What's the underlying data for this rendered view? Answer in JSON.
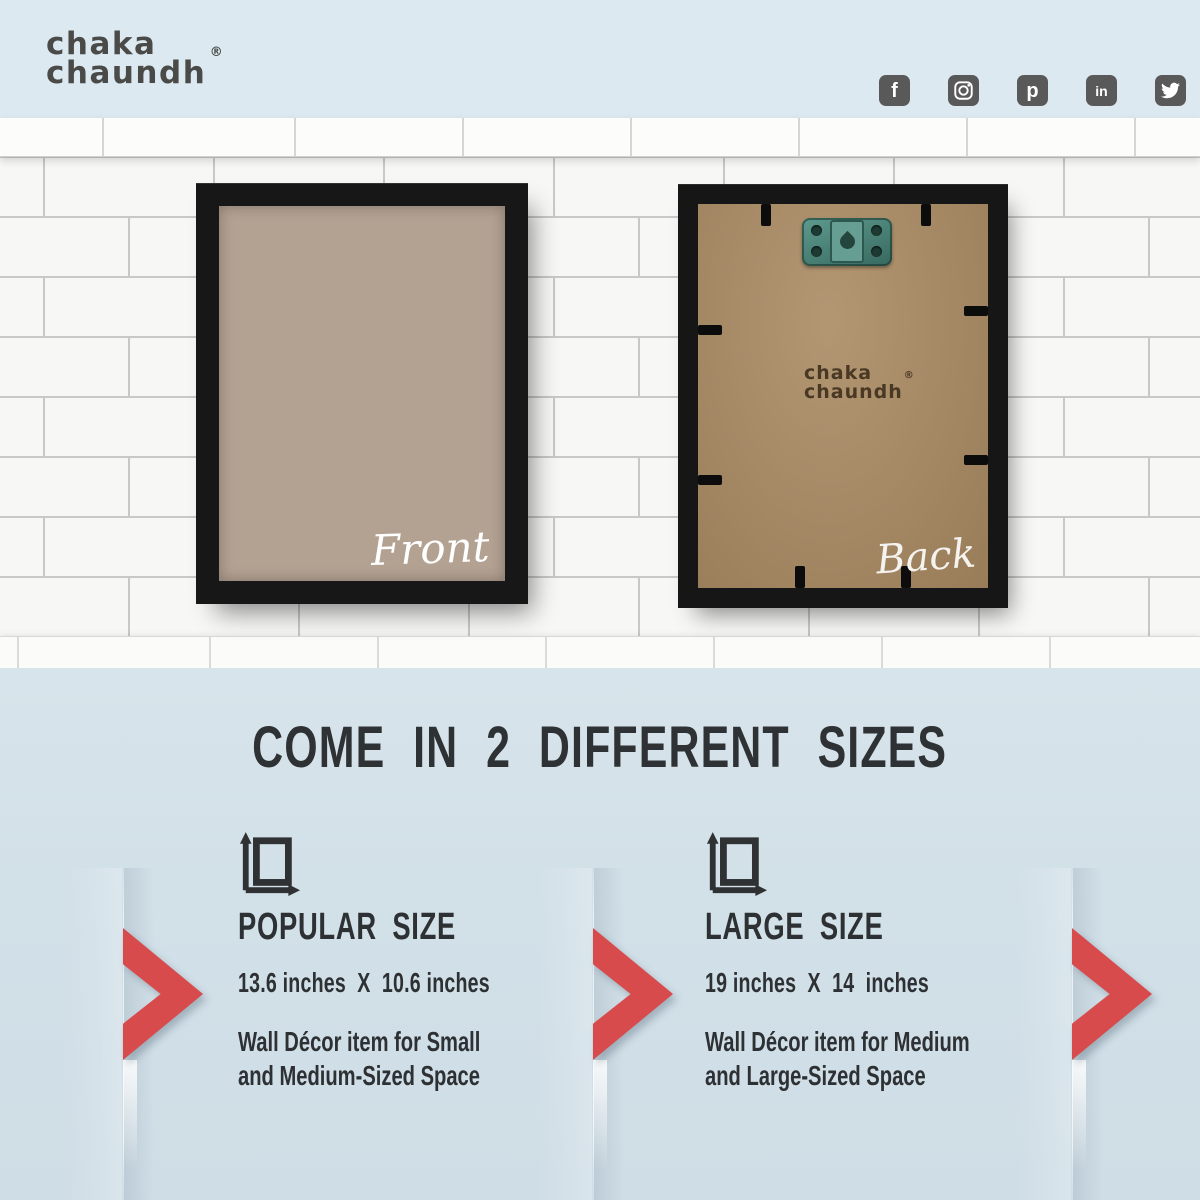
{
  "brand": {
    "line1": "chaka",
    "line2": "chaundh",
    "registered_mark": "®"
  },
  "social": {
    "platforms": [
      "facebook",
      "instagram",
      "pinterest",
      "linkedin",
      "twitter"
    ],
    "facebook_glyph": "f",
    "pinterest_glyph": "p",
    "linkedin_glyph": "in"
  },
  "frames": {
    "front": {
      "label": "Front"
    },
    "back": {
      "label": "Back",
      "stamp": {
        "line1": "chaka",
        "line2": "chaundh",
        "registered_mark": "®"
      }
    }
  },
  "sizes": {
    "heading": "COME IN 2 DIFFERENT SIZES",
    "options": [
      {
        "title": "POPULAR SIZE",
        "dimensions": "13.6 inches  X  10.6 inches",
        "description": "Wall Décor item for Small\nand Medium-Sized Space"
      },
      {
        "title": "LARGE SIZE",
        "dimensions": "19 inches  X  14  inches",
        "description": "Wall Décor item for Medium\nand Large-Sized Space"
      }
    ]
  },
  "colors": {
    "accent_red": "#d84b4d",
    "band_blue": "#dce9f0",
    "section_blue": "#d2e0e8",
    "text_dark": "#2e3133",
    "frame_black": "#171717",
    "mat_beige": "#b3a192",
    "board_brown": "#aa8a62",
    "social_gray": "#595959"
  }
}
